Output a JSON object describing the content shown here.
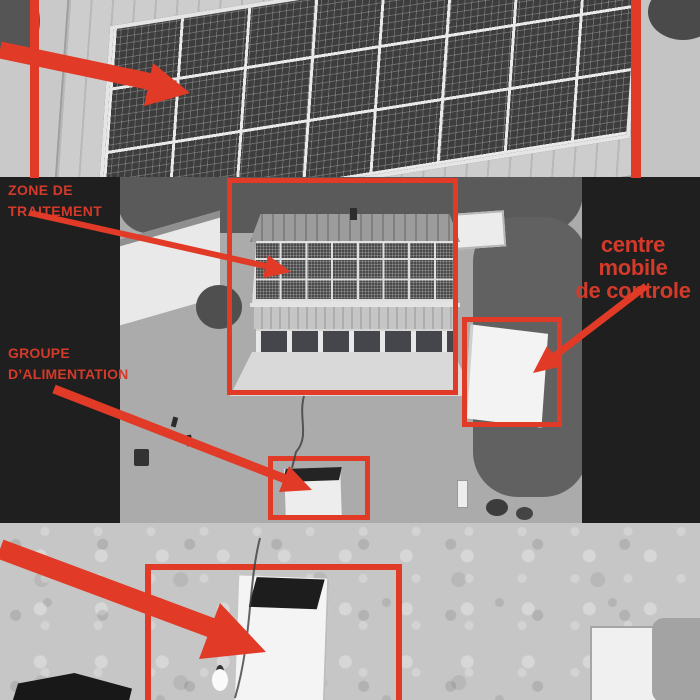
{
  "scene": {
    "description": "Grayscale aerial drone photos of a treatment site with rooftop solar panels, annotated with red boxes and arrows",
    "photos": {
      "top": "close-up of large rooftop solar panel array",
      "middle": "overhead view of building with solar roof, mobile control trailer and power unit shed",
      "bottom": "close-up of white power unit trailer"
    }
  },
  "labels": {
    "zone": {
      "line1": "ZONE DE",
      "line2": "TRAITEMENT"
    },
    "groupe": {
      "line1": "GROUPE",
      "line2": "D’ALIMENTATION"
    },
    "centre": {
      "line1": "centre mobile",
      "line2": "de controle"
    }
  },
  "colors": {
    "annotation_red": "#e13a26",
    "label_red": "#d43a2a",
    "caption_panel_black": "#1f1f1f",
    "photo_gray": "#b5b5b5"
  }
}
